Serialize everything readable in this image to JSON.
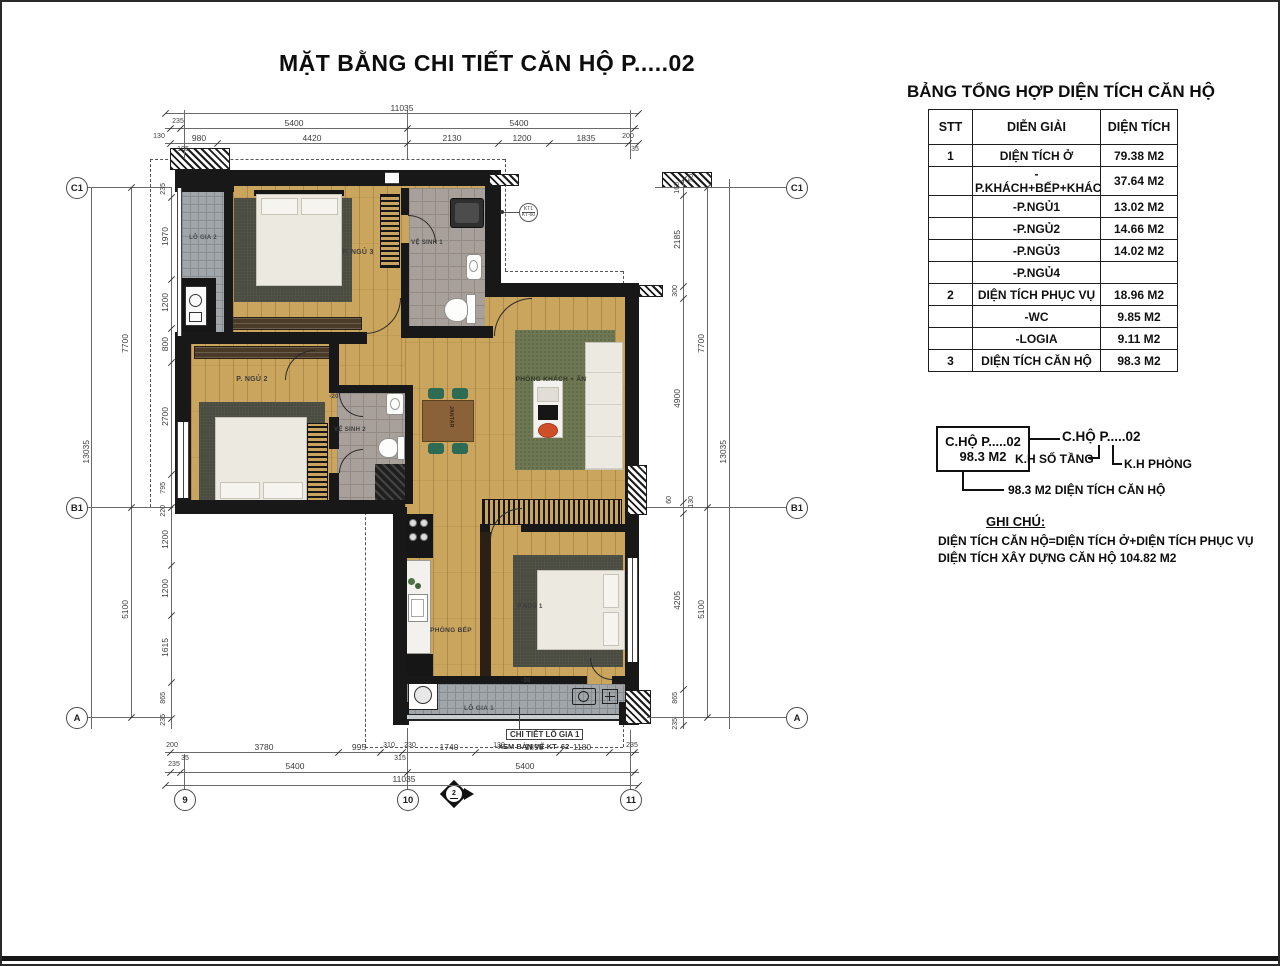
{
  "title": "MẶT BẰNG CHI TIẾT CĂN HỘ  P.....02",
  "colors": {
    "wood": "#caa55e",
    "wall": "#181818",
    "tile_balcony": "#9fa5a8",
    "tile_bath": "#a8a19b",
    "rug_dark": "#4a4c40",
    "rug_green": "#6d7751",
    "furniture_white": "#ece9e1",
    "chair_green": "#2e6b55",
    "table_wood": "#8a6239",
    "accent_orange": "#cf4f28"
  },
  "area_table": {
    "title": "BẢNG TỔNG HỢP DIỆN TÍCH CĂN HỘ",
    "columns": [
      "STT",
      "DIỄN GIẢI",
      "DIỆN TÍCH"
    ],
    "rows": [
      {
        "stt": "1",
        "label": "DIỆN TÍCH Ở",
        "area": "79.38 M2"
      },
      {
        "stt": "",
        "label": "-P.KHÁCH+BẾP+KHÁC",
        "area": "37.64 M2"
      },
      {
        "stt": "",
        "label": "-P.NGỦ1",
        "area": "13.02 M2"
      },
      {
        "stt": "",
        "label": "-P.NGỦ2",
        "area": "14.66 M2"
      },
      {
        "stt": "",
        "label": "-P.NGỦ3",
        "area": "14.02 M2"
      },
      {
        "stt": "",
        "label": "-P.NGỦ4",
        "area": ""
      },
      {
        "stt": "2",
        "label": "DIỆN TÍCH PHỤC VỤ",
        "area": "18.96 M2"
      },
      {
        "stt": "",
        "label": "-WC",
        "area": "9.85 M2"
      },
      {
        "stt": "",
        "label": "-LOGIA",
        "area": "9.11 M2"
      },
      {
        "stt": "3",
        "label": "DIỆN TÍCH CĂN HỘ",
        "area": "98.3 M2"
      }
    ]
  },
  "legend": {
    "unit_box_line1": "C.HỘ P.....02",
    "unit_box_line2": "98.3 M2",
    "unit_code": "C.HỘ P.....02",
    "floor_label": "K.H SỐ TẦNG",
    "room_label": "K.H PHÒNG",
    "area_note": "98.3 M2 DIỆN TÍCH CĂN HỘ",
    "notes_title": "GHI CHÚ:",
    "note1": "DIỆN TÍCH CĂN HỘ=DIỆN TÍCH Ở+DIỆN TÍCH PHỤC VỤ",
    "note2": "DIỆN TÍCH XÂY DỰNG CĂN HỘ 104.82 M2"
  },
  "plan": {
    "rooms": {
      "lo_gia_2": "LÔ GIA 2",
      "p_ngu_3": "P. NGỦ 3",
      "ve_sinh_1": "VỆ SINH 1",
      "p_ngu_2": "P. NGỦ 2",
      "ve_sinh_2": "VỆ SINH 2",
      "khach": "PHÒNG KHÁCH + ĂN",
      "bep": "PHÒNG BẾP",
      "p_ngu_1": "P.NGỦ 1",
      "lo_gia_1": "LÔ GIA 1",
      "table_brand": "JANTAR"
    },
    "marks": {
      "level_vs2": "-20",
      "level_logia": "-30",
      "kitchen": "3.20",
      "callout_top": "KT1",
      "callout_bottom": "KT-60",
      "detail_line1": "CHI TIẾT LÔ GIA 1",
      "detail_line2": "XEM BẢN VẼ KT- 62",
      "section": "2"
    },
    "grid": {
      "left": [
        "C1",
        "B1",
        "A"
      ],
      "bottom": [
        "9",
        "10",
        "11"
      ]
    },
    "dims": {
      "top": {
        "total": "11035",
        "row2": [
          "235",
          "5400",
          "5400"
        ],
        "row3": [
          "130",
          "980",
          "4420",
          "2130",
          "1200",
          "1835",
          "200"
        ],
        "sub": [
          "105",
          "35"
        ]
      },
      "left": {
        "total": "13035",
        "mid": [
          "7700",
          "5100"
        ],
        "chain": [
          "235",
          "1970",
          "1200",
          "800",
          "2700",
          "795",
          "220",
          "1200",
          "1200",
          "1615",
          "865",
          "235"
        ]
      },
      "right": {
        "total": "13035",
        "mid": [
          "7700",
          "5100"
        ],
        "chain": [
          "50",
          "160",
          "2185",
          "300",
          "4900",
          "60",
          "130",
          "4205",
          "865",
          "235"
        ]
      },
      "bottom": {
        "total": "11035",
        "row2": [
          "235",
          "5400",
          "5400"
        ],
        "row1": [
          "200",
          "3780",
          "995",
          "310",
          "230",
          "1740",
          "130",
          "1890",
          "1180",
          "235"
        ],
        "sub": [
          "35",
          "315"
        ]
      }
    }
  }
}
